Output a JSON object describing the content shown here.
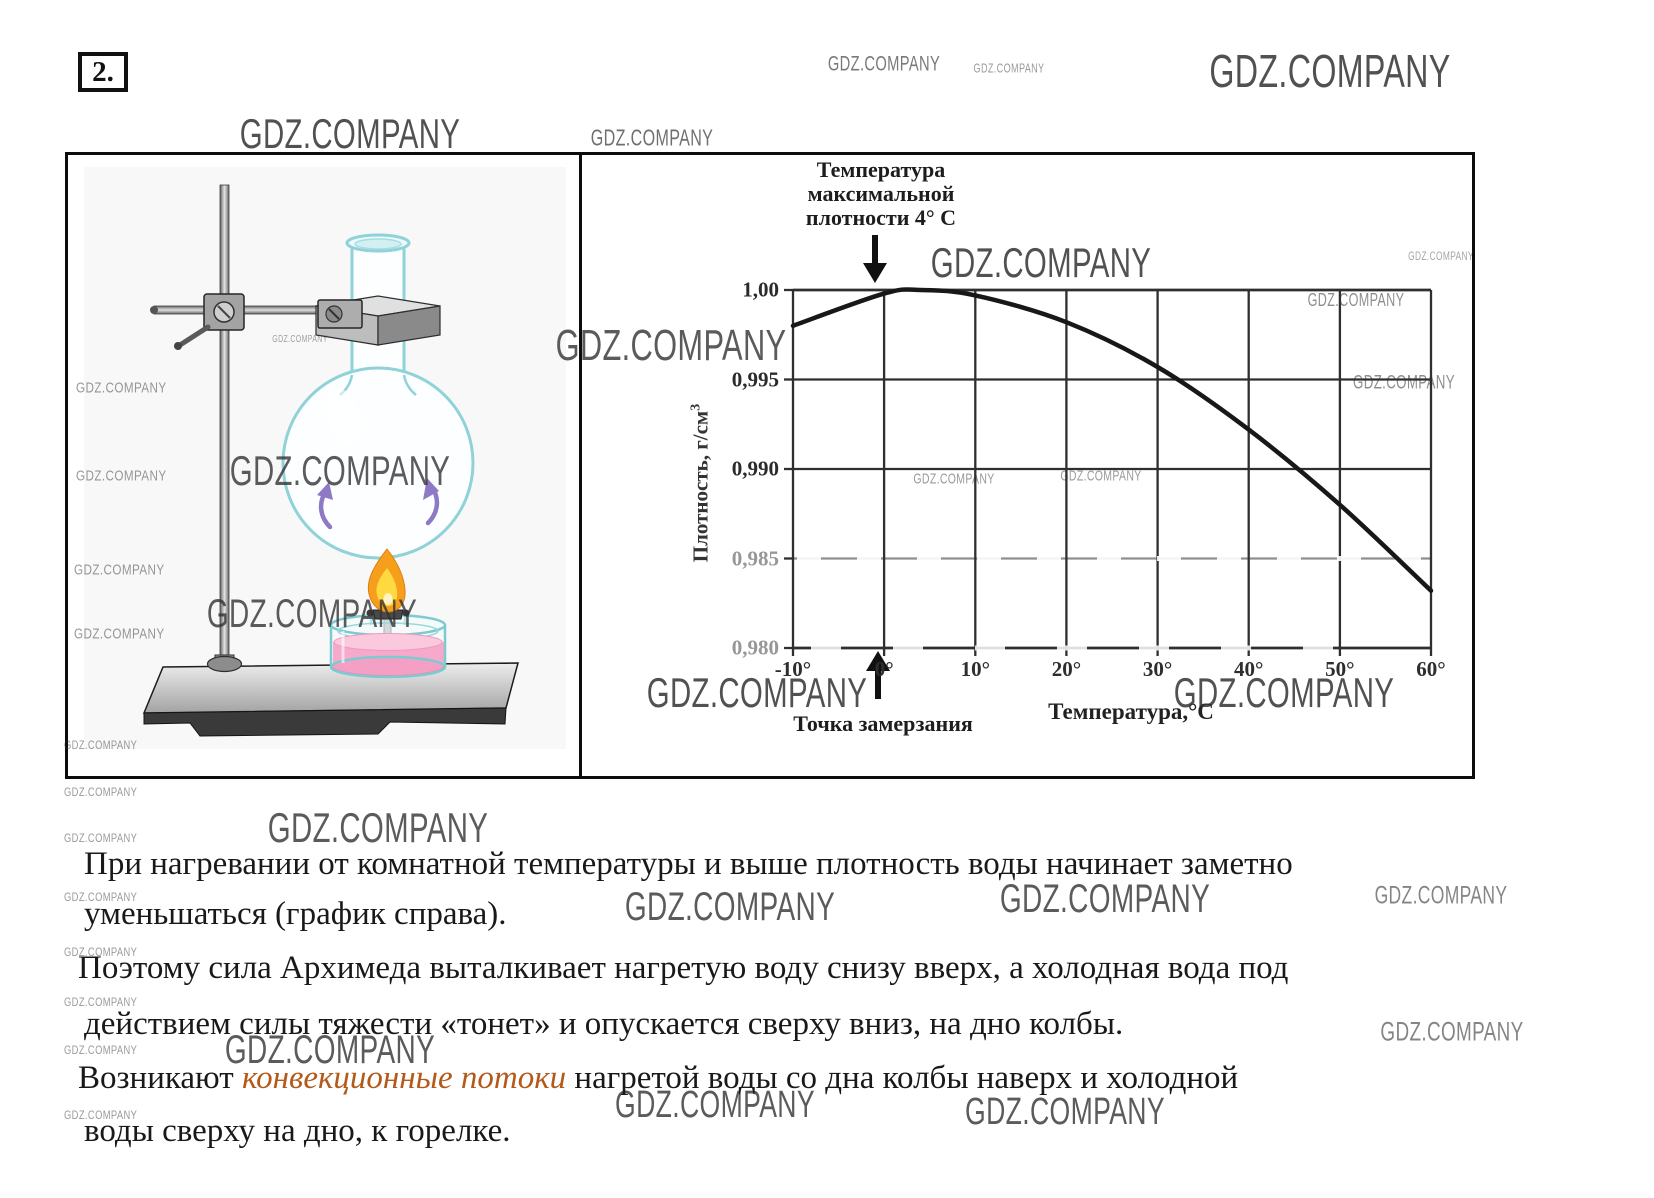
{
  "page": {
    "task_number": "2."
  },
  "watermark_text": "GDZ.COMPANY",
  "figure": {
    "annotation_lines": [
      "Температура",
      "максимальной",
      "плотности 4° С"
    ],
    "freezing_label": "Точка замерзания"
  },
  "chart_data": {
    "type": "line",
    "title": "Зависимость плотности воды от температуры",
    "series": [
      {
        "name": "Плотность воды",
        "x": [
          -10,
          0,
          4,
          10,
          20,
          30,
          40,
          50,
          60
        ],
        "y": [
          0.998,
          0.9998,
          1.0,
          0.9997,
          0.9982,
          0.9957,
          0.9922,
          0.988,
          0.9832
        ]
      }
    ],
    "xlabel": "Температура,°C",
    "ylabel": "Плотность, г/см³",
    "ylabel_main": "Плотность, г/см",
    "ylabel_sup": "3",
    "x_ticks": [
      -10,
      0,
      10,
      20,
      30,
      40,
      50,
      60
    ],
    "x_tick_labels": [
      "-10°",
      "0°",
      "10°",
      "20°",
      "30°",
      "40°",
      "50°",
      "60°"
    ],
    "y_ticks": [
      1.0,
      0.995,
      0.99,
      0.985,
      0.98
    ],
    "y_tick_labels": [
      "1,00",
      "0,995",
      "0,990",
      "0,985",
      "0,980"
    ],
    "xlim": [
      -10,
      60
    ],
    "ylim": [
      0.98,
      1.0
    ],
    "grid": true,
    "legend": "none",
    "annotations": [
      "Температура максимальной плотности 4° С",
      "Точка замерзания"
    ]
  },
  "text": {
    "highlight_color": "#b35a1a",
    "lines": [
      {
        "segments": [
          {
            "t": "При нагревании от комнатной температуры и выше плотность воды начинает заметно"
          }
        ]
      },
      {
        "segments": [
          {
            "t": "уменьшаться (график справа)."
          }
        ]
      },
      {
        "segments": [
          {
            "t": "Поэтому сила Архимеда выталкивает нагретую воду снизу вверх, а холодная вода под"
          }
        ]
      },
      {
        "segments": [
          {
            "t": "действием силы тяжести «тонет» и опускается сверху вниз, на дно колбы."
          }
        ]
      },
      {
        "segments": [
          {
            "t": "Возникают "
          },
          {
            "t": "конвекционные потоки",
            "hl": true
          },
          {
            "t": " нагретой воды со дна колбы наверх и холодной"
          }
        ]
      },
      {
        "segments": [
          {
            "t": "воды сверху на дно, к горелке."
          }
        ]
      }
    ]
  },
  "colors": {
    "highlight": "#b35a1a",
    "flask_outline": "#8fd2d8",
    "lamp_liquid_pink": "#f6a9ca",
    "flame_orange": "#f69f1c",
    "flame_yellow": "#ffd940",
    "convection_arrow_purple": "#8d79c5",
    "curve": "#181818"
  }
}
